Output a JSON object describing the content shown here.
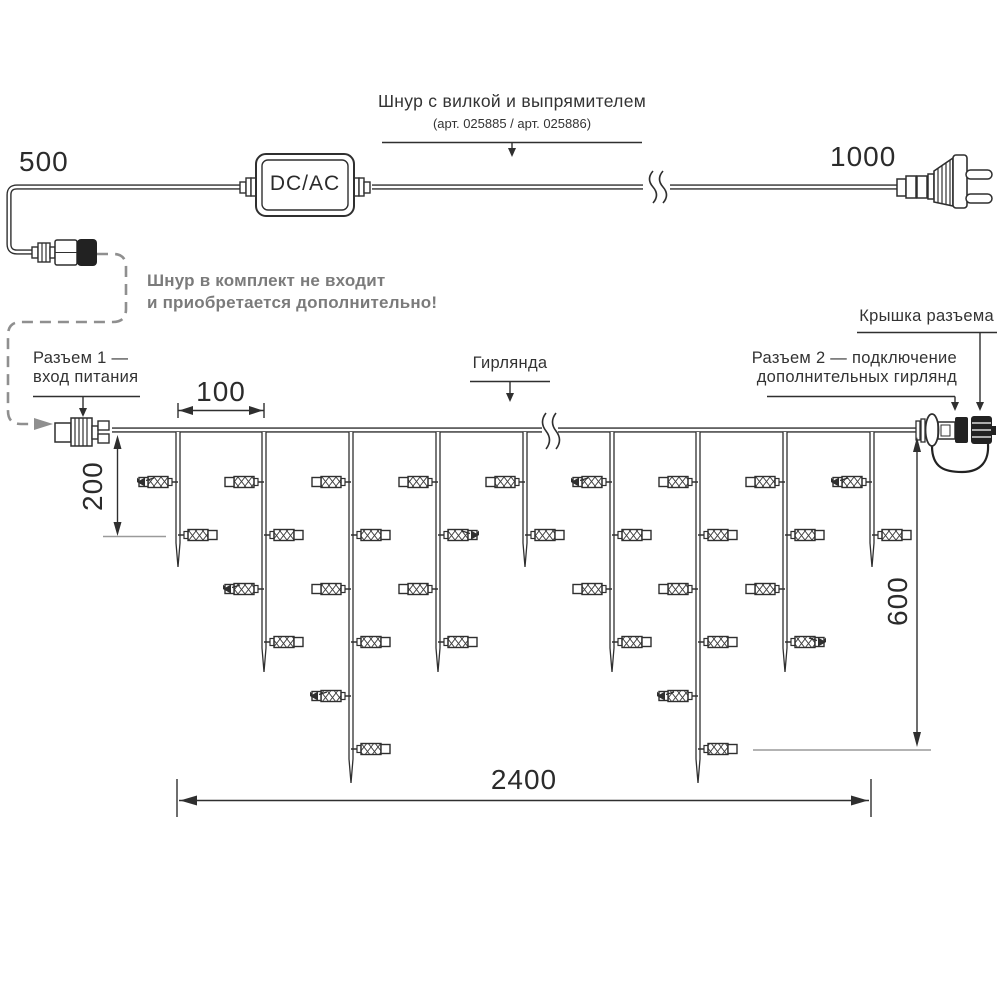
{
  "colors": {
    "ink": "#2b2b2b",
    "line": "#2f2f2f",
    "gray_line": "#9a9a9a",
    "dashed_line": "#8f8f8f",
    "note_text": "#7b7b7b"
  },
  "power_cord": {
    "length_left_label": "500",
    "length_right_label": "1000",
    "converter_label": "DC/AC",
    "title": "Шнур с вилкой и выпрямителем",
    "subtitle": "(арт. 025885 / арт. 025886)",
    "note_line1": "Шнур в комплект не входит",
    "note_line2": "и приобретается дополнительно!"
  },
  "garland": {
    "connector1_line1": "Разъем 1 —",
    "connector1_line2": "вход питания",
    "name_label": "Гирлянда",
    "connector2_line1": "Разъем 2 — подключение",
    "connector2_line2": "дополнительных гирлянд",
    "cap_label": "Крышка разъема",
    "dim_drop_spacing": "100",
    "dim_first_drop": "200",
    "dim_height": "600",
    "dim_length": "2400"
  },
  "diagram": {
    "wire_y": 430,
    "drop_xs": [
      178,
      264,
      351,
      438,
      525,
      612,
      698,
      785,
      872
    ],
    "drop_types": [
      "S",
      "M",
      "L",
      "M",
      "S",
      "M",
      "L",
      "M",
      "S"
    ],
    "tip_y": {
      "S": 567,
      "M": 672,
      "L": 783
    },
    "lamp_rows_y": [
      482,
      535,
      589,
      642,
      696,
      749
    ],
    "lamps_per_type": {
      "S": 2,
      "M": 4,
      "L": 6
    },
    "marked_lamps": [
      {
        "drop": 0,
        "row": 0
      },
      {
        "drop": 1,
        "row": 2
      },
      {
        "drop": 2,
        "row": 4
      },
      {
        "drop": 3,
        "row": 1
      },
      {
        "drop": 5,
        "row": 0
      },
      {
        "drop": 6,
        "row": 4
      },
      {
        "drop": 7,
        "row": 3
      },
      {
        "drop": 8,
        "row": 0
      }
    ]
  }
}
